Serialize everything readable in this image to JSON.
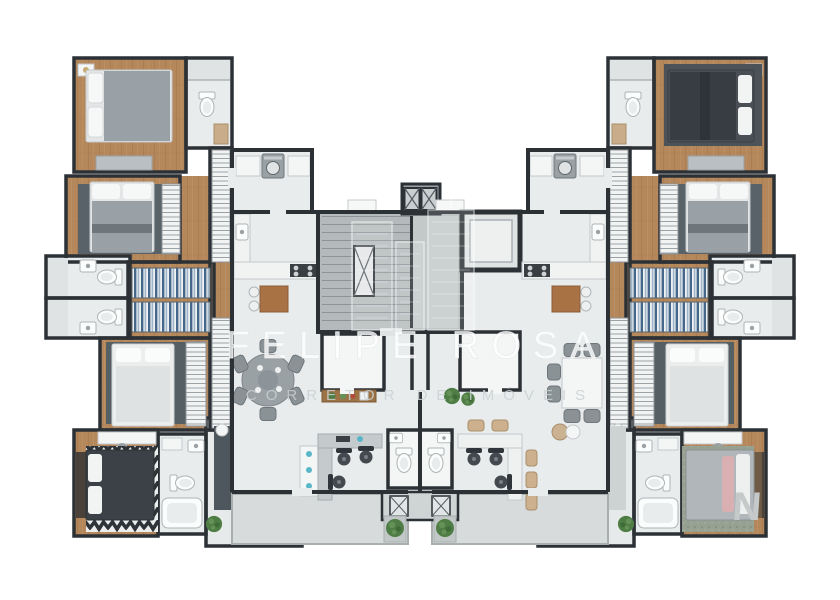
{
  "watermark": {
    "brand": "FELIPE ROSA",
    "tagline": "CORRETOR DE IMÓVEIS",
    "corner_mark": "N",
    "logo": "city-skyline-icon"
  },
  "palette": {
    "background": "#ffffff",
    "wall": "#2c3136",
    "wood_floor": "#b5885c",
    "tile_floor": "#e9eced",
    "stair_concrete": "#b4babc",
    "terrace_floor": "#d7dbdb",
    "dark_rug": "#4d575d",
    "chevron_rug": "#2e3338",
    "sofa_gray": "#b6bcbf",
    "accent_blue": "#58b6c8",
    "plant_green": "#4e7d45",
    "wood_furniture": "#a97245"
  },
  "plan": {
    "type": "residential-building-floor-plan-3d-render",
    "left_wing_rooms": [
      "bedroom",
      "bathroom",
      "bedroom",
      "closet-hall",
      "bathroom",
      "bathroom",
      "bedroom",
      "corridor",
      "bedroom",
      "bathroom",
      "living-room"
    ],
    "center_rooms": [
      "laundry-left",
      "kitchen-left",
      "dining-left",
      "stair-core",
      "elevator-bank",
      "elevator-lobby",
      "storage-left",
      "storage-right",
      "entry-hall",
      "wc-left",
      "wc-right",
      "office-left",
      "office-right",
      "terrace-left",
      "terrace-right",
      "kitchen-right",
      "laundry-right",
      "dining-right"
    ],
    "right_wing_rooms": [
      "bedroom",
      "bathroom",
      "bedroom",
      "closet-hall",
      "bathroom",
      "bathroom",
      "bedroom",
      "corridor",
      "bedroom",
      "bathroom",
      "living-room"
    ]
  }
}
